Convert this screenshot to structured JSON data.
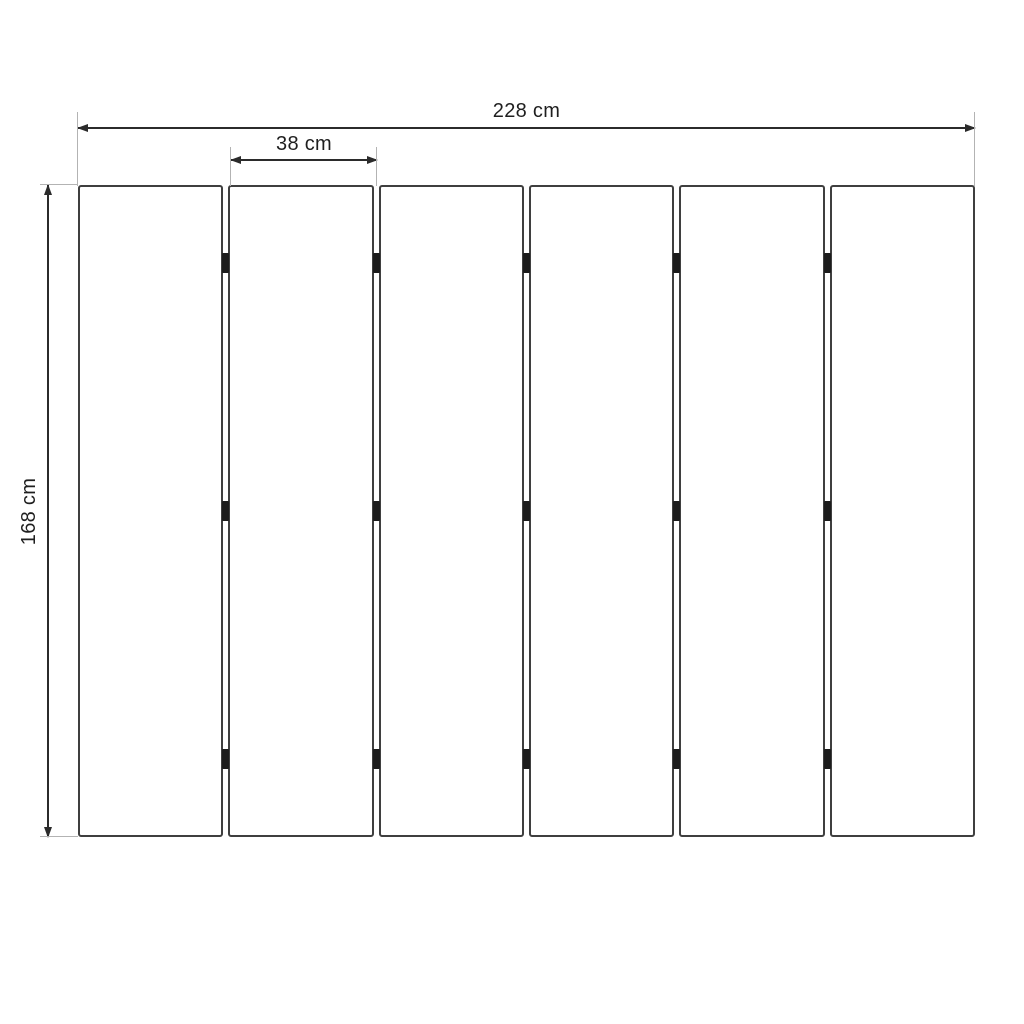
{
  "diagram": {
    "kind": "panel-dimension-drawing",
    "labels": {
      "total_width": "228 cm",
      "panel_width": "38 cm",
      "height": "168 cm"
    },
    "values": {
      "total_width_cm": 228,
      "panel_width_cm": 38,
      "height_cm": 168,
      "unit": "cm"
    },
    "panels": {
      "count": 6,
      "gap_count": 5,
      "hinge_rows": 3,
      "hinge_row_percents": [
        12,
        50,
        88
      ]
    },
    "colors": {
      "background": "#ffffff",
      "panel_border": "#3f3f3f",
      "hinge": "#1c1c1c",
      "dimension_line": "#2b2b2b",
      "extension_line": "#b3b3b3",
      "text": "#1f1f1f"
    }
  }
}
